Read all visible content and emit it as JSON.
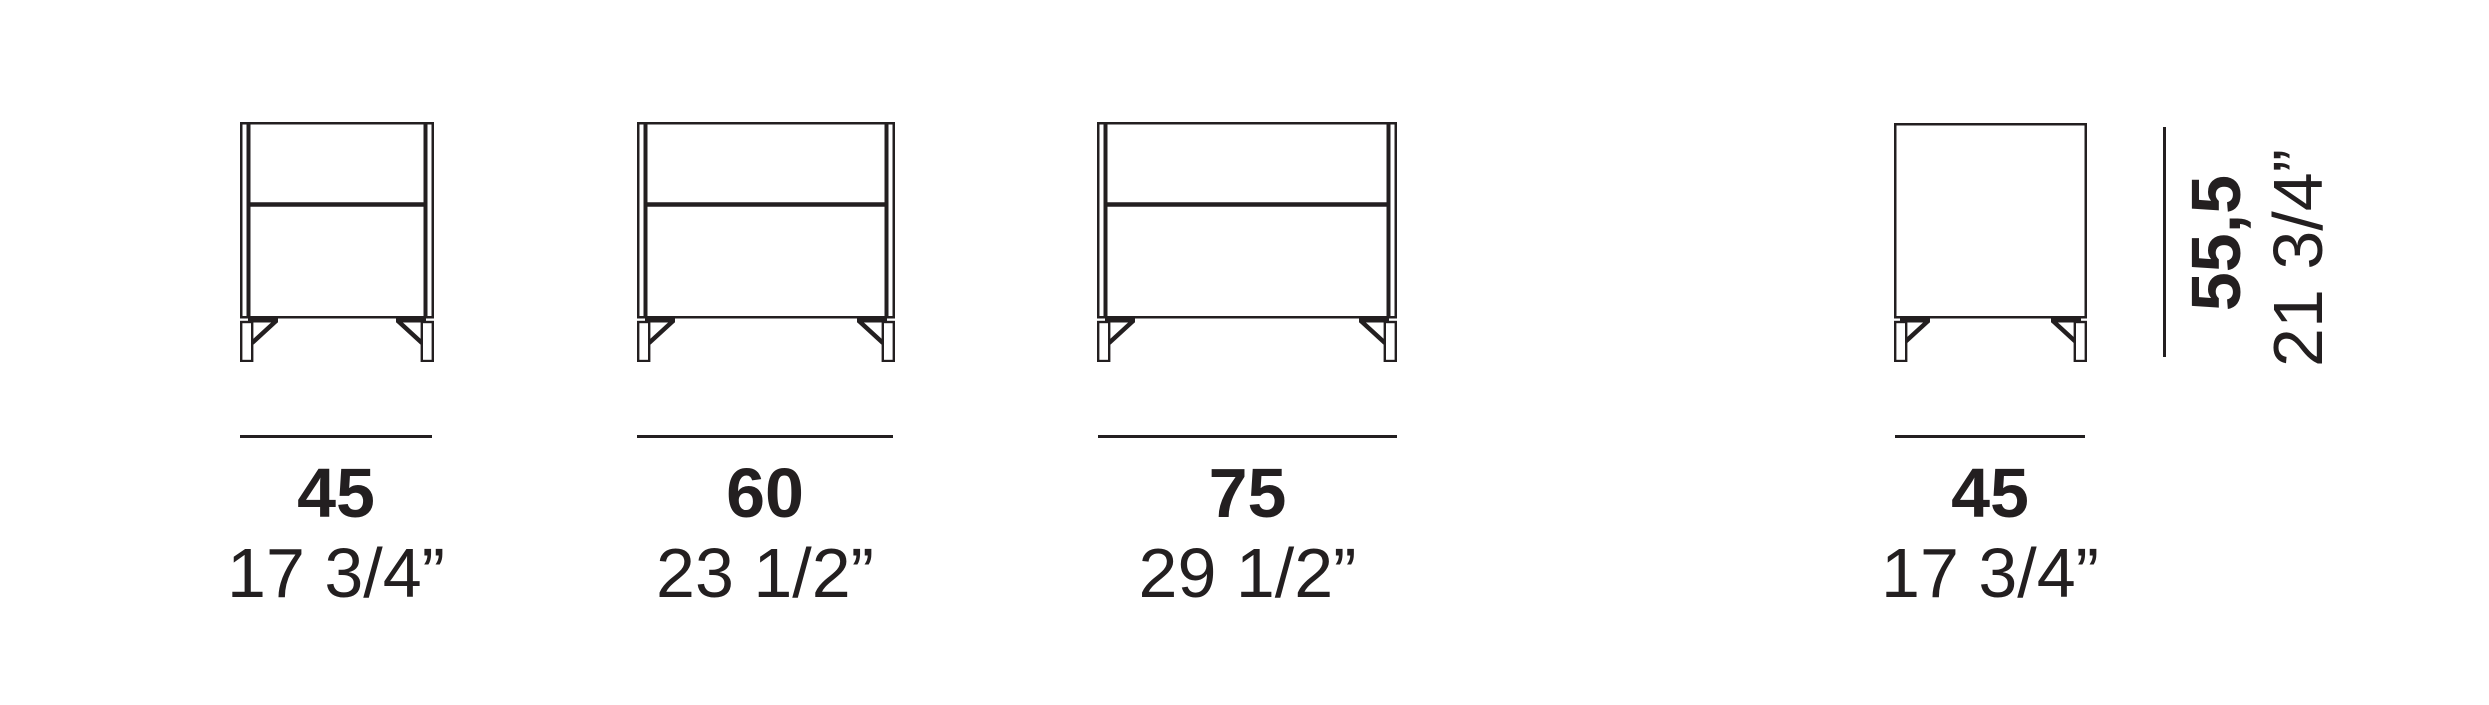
{
  "diagram": {
    "background_color": "#ffffff",
    "ink_color": "#231f20",
    "units": [
      {
        "view": "front",
        "width_cm": "45",
        "width_inches": "17 3/4”"
      },
      {
        "view": "front",
        "width_cm": "60",
        "width_inches": "23 1/2”"
      },
      {
        "view": "front",
        "width_cm": "75",
        "width_inches": "29 1/2”"
      },
      {
        "view": "side",
        "width_cm": "45",
        "width_inches": "17 3/4”"
      }
    ],
    "height_dimension": {
      "height_cm": "55,5",
      "height_inches": "21 3/4”"
    }
  }
}
